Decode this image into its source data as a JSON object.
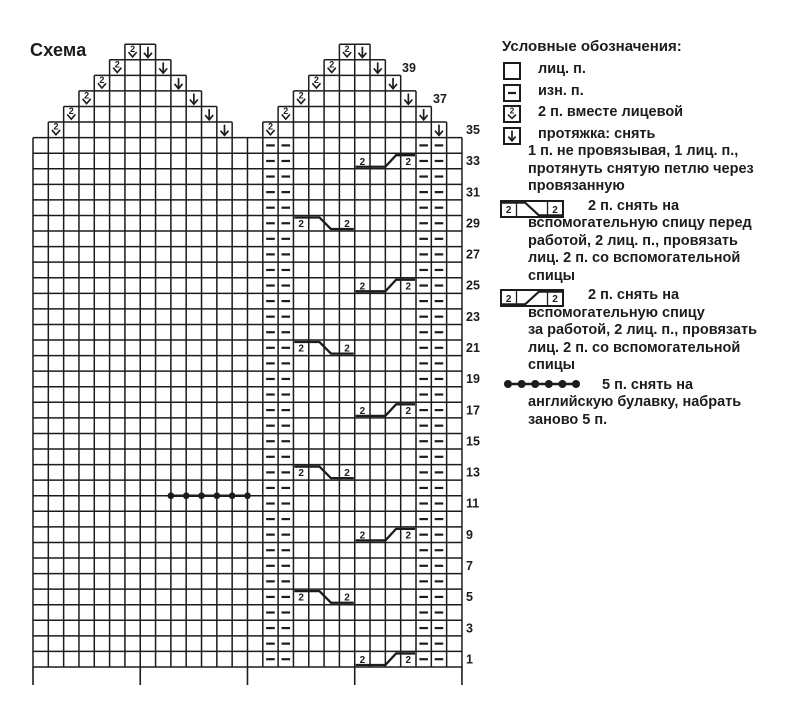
{
  "title": "Схема",
  "colors": {
    "ink": "#1c1c1c",
    "background": "#ffffff"
  },
  "chart": {
    "total_rows": 40,
    "full_width_rows": 34,
    "columns": 28,
    "row_numbers": [
      1,
      3,
      5,
      7,
      9,
      11,
      13,
      15,
      17,
      19,
      21,
      23,
      25,
      27,
      29,
      31,
      33,
      35,
      37,
      39
    ],
    "purl_columns": [
      16,
      17,
      26,
      27
    ],
    "pyramids": [
      {
        "name": "left-peak",
        "apex_left_col": 7,
        "rows": 6
      },
      {
        "name": "right-peak",
        "apex_left_col": 21,
        "rows": 6
      }
    ],
    "k2tog_numeral": "2",
    "cable_numeral": "2",
    "cables": [
      {
        "row": 33,
        "type": "back"
      },
      {
        "row": 29,
        "type": "front"
      },
      {
        "row": 25,
        "type": "back"
      },
      {
        "row": 21,
        "type": "front"
      },
      {
        "row": 17,
        "type": "back"
      },
      {
        "row": 13,
        "type": "front"
      },
      {
        "row": 9,
        "type": "back"
      },
      {
        "row": 5,
        "type": "front"
      },
      {
        "row": 1,
        "type": "back"
      }
    ],
    "cable_start_col": {
      "front": 18,
      "back": 22
    },
    "cable_width": 4,
    "safety_pin": {
      "above_row": 11,
      "start_col": 10,
      "stitches": 5
    },
    "section_tick_cols": [
      0,
      7,
      14,
      21,
      28
    ]
  },
  "legend": {
    "title": "Условные обозначения:",
    "items": [
      {
        "symbol": "knit-box",
        "name": "knit-stitch-icon",
        "lines": [
          "лиц. п."
        ]
      },
      {
        "symbol": "purl-box",
        "name": "purl-stitch-icon",
        "lines": [
          "изн. п."
        ]
      },
      {
        "symbol": "k2tog-box",
        "name": "k2tog-icon",
        "lines": [
          "2 п. вместе лицевой"
        ]
      },
      {
        "symbol": "slip-box",
        "name": "slip-stitch-icon",
        "lines": [
          "протяжка: снять",
          "1 п. не провязывая, 1 лиц. п.,",
          "протянуть снятую петлю через",
          "провязанную"
        ]
      },
      {
        "symbol": "cable-front",
        "name": "cable-front-icon",
        "lines": [
          "2 п. снять на",
          "вспомогательную спицу перед",
          "работой, 2 лиц. п., провязать",
          "лиц. 2 п. со вспомогательной",
          "спицы"
        ]
      },
      {
        "symbol": "cable-back",
        "name": "cable-back-icon",
        "lines": [
          "2 п. снять на",
          "вспомогательную спицу",
          "за работой, 2 лиц. п., провязать",
          "лиц. 2 п. со вспомогательной",
          "спицы"
        ]
      },
      {
        "symbol": "pin-dots",
        "name": "safety-pin-icon",
        "lines": [
          "5 п. снять на",
          "английскую булавку, набрать",
          "заново 5 п."
        ]
      }
    ]
  }
}
